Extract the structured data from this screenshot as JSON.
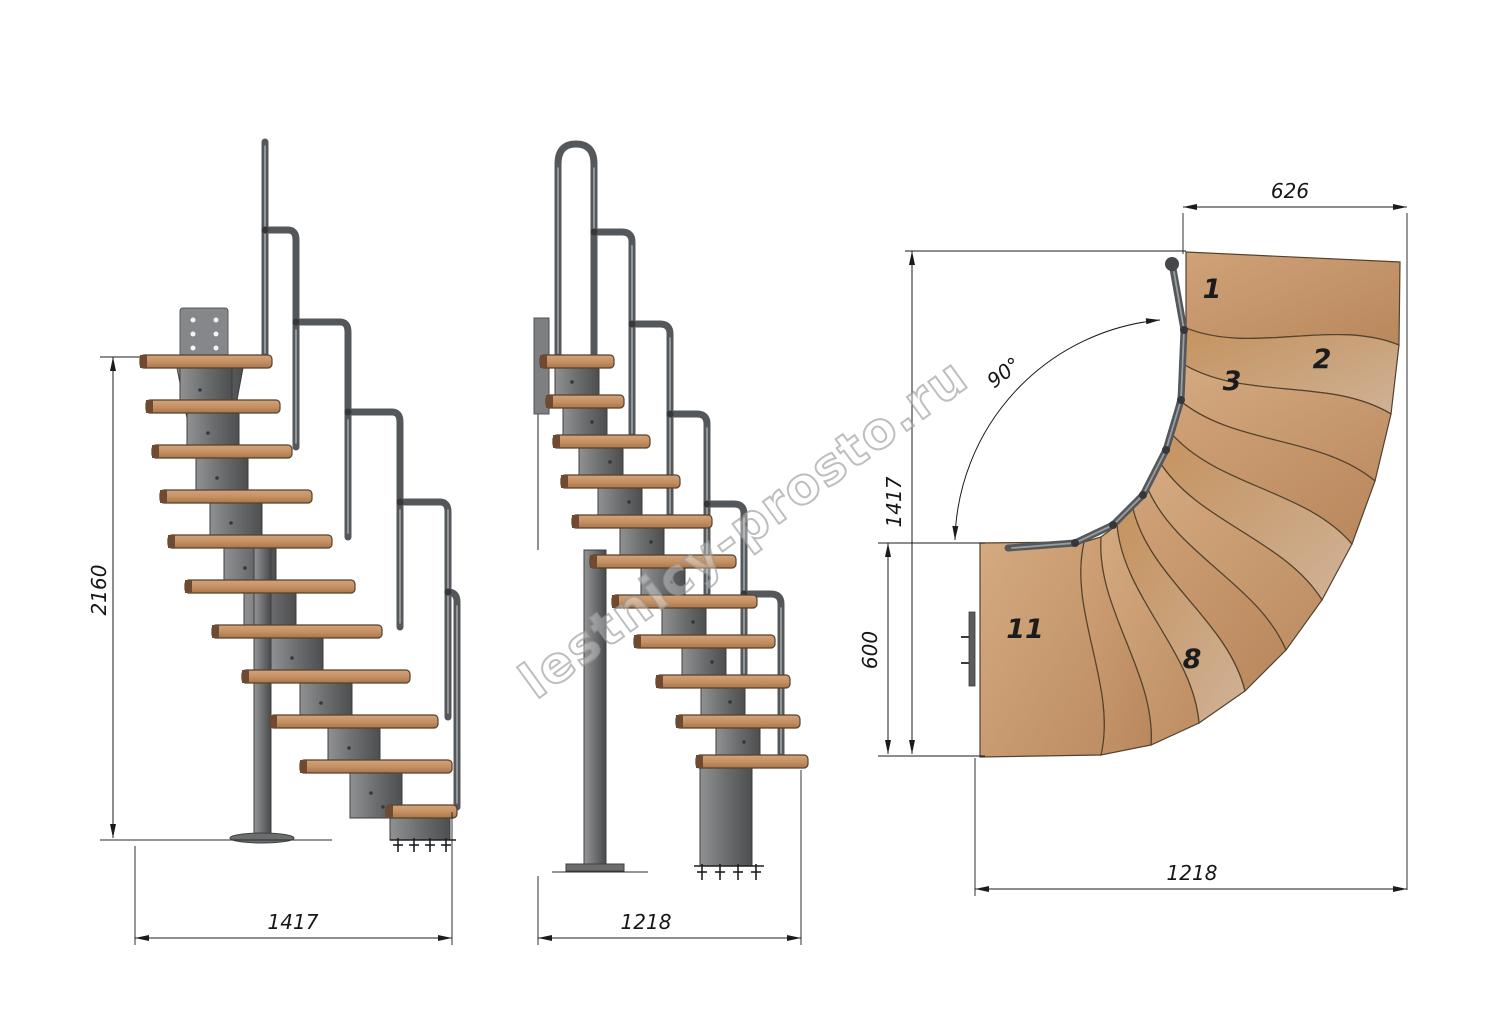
{
  "watermark": {
    "text": "lestnicy-prosto.ru"
  },
  "views": {
    "left_elevation": {
      "height_dim": "2160",
      "width_dim": "1417"
    },
    "middle_elevation": {
      "width_dim": "1218"
    },
    "plan": {
      "opening_width_dim": "626",
      "turn_angle_dim": "90°",
      "depth_dim": "1417",
      "landing_width_dim": "600",
      "total_width_dim": "1218",
      "step_labels": {
        "step1": "1",
        "step2": "2",
        "step3": "3",
        "step8": "8",
        "step11": "11"
      }
    }
  },
  "colors": {
    "wood": "#c89a6e",
    "wood_dark": "#8a5c39",
    "steel": "#6a6c6e",
    "steel_dark": "#3d3f41",
    "dim_line": "#1b1b1b",
    "watermark_gray": "#969696"
  }
}
